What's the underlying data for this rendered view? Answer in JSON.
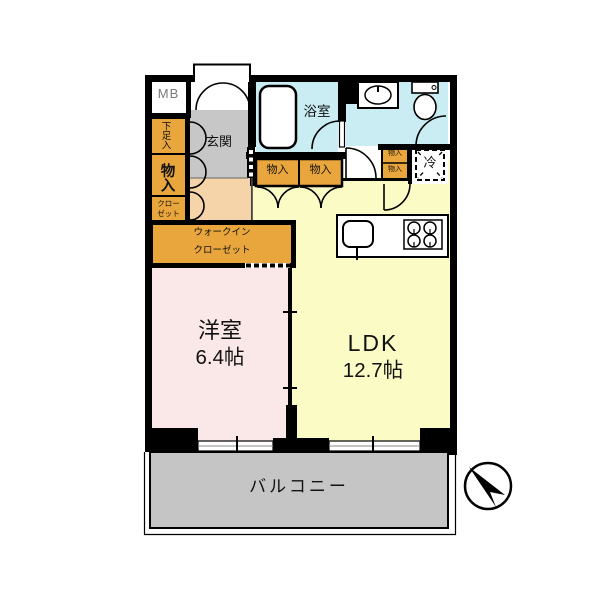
{
  "plan": {
    "meter_box": "MB",
    "entrance": "玄関",
    "bathroom": "浴室",
    "shoe_cabinet": "下足入",
    "storage_left": "物入",
    "closet_left_line1": "クロー",
    "closet_left_line2": "ゼット",
    "storage_band_1": "物入",
    "storage_band_2": "物入",
    "storage_small_1": "物入",
    "storage_small_2": "物入",
    "refrigerator": "冷",
    "walk_in_closet_line1": "ウォークイン",
    "walk_in_closet_line2": "クローゼット",
    "western_room_name": "洋室",
    "western_room_size": "6.4帖",
    "ldk_name": "LDK",
    "ldk_size": "12.7帖",
    "balcony": "バルコニー"
  },
  "colors": {
    "closet_orange": "#E9A63C",
    "room_pink": "#FAE8E8",
    "ldk_yellow": "#FBFBC6",
    "wet_area_blue": "#C9EDF2",
    "entrance_gray": "#C7C7C7",
    "hall_beige": "#F4D4A8",
    "balcony_gray": "#C5C5C5",
    "wall_black": "#000000"
  },
  "fixtures": {
    "bathtub": "bathtub",
    "toilet": "toilet",
    "washbasin": "washbasin",
    "kitchen_sink": "kitchen-sink",
    "gas_stove": "gas-stove",
    "refrigerator_space": "refrigerator-space",
    "compass": "north-arrow"
  }
}
